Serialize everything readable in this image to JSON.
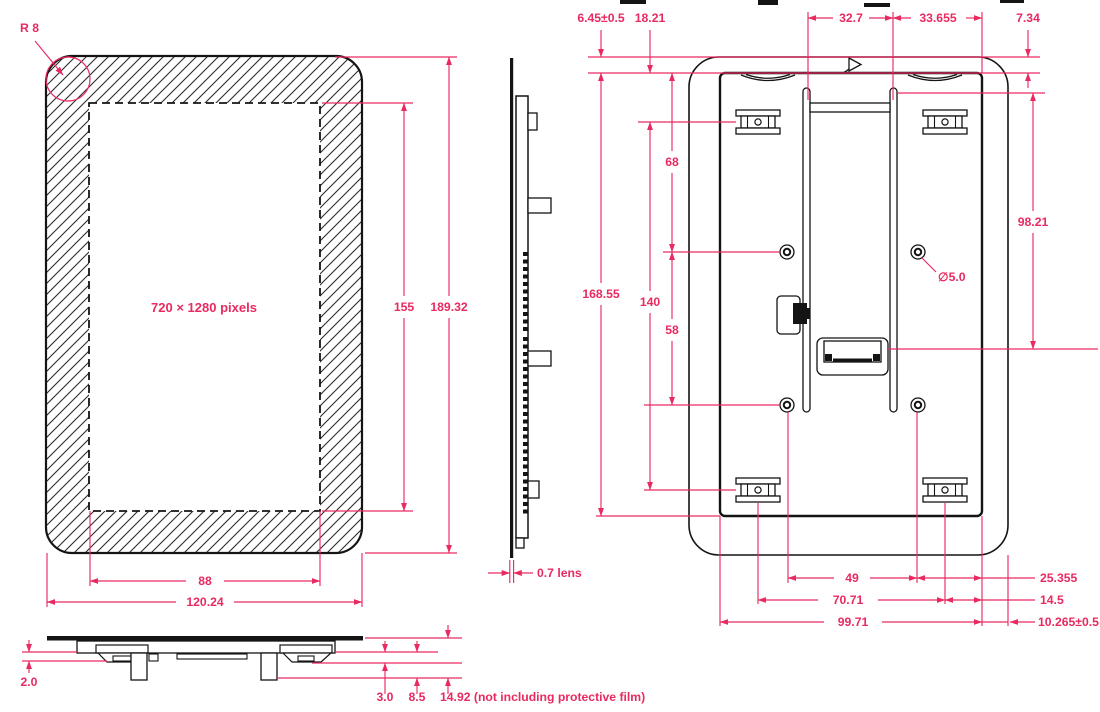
{
  "accent_color": "#e92a60",
  "ink_color": "#141414",
  "front_view": {
    "radius_label": "R 8",
    "screen_label": "720 × 1280 pixels",
    "dim_screen_height": "155",
    "dim_overall_height": "189.32",
    "dim_screen_width": "88",
    "dim_overall_width": "120.24"
  },
  "side_view": {
    "dim_lens": "0.7 lens"
  },
  "bottom_view": {
    "dim_step_small": "2.0",
    "dim_step_1": "3.0",
    "dim_step_2": "8.5",
    "dim_overall_thickness": "14.92 (not including protective film)"
  },
  "back_view": {
    "dim_top_left_offset": "6.45±0.5",
    "dim_top_inner_offset": "18.21",
    "dim_rail_span": "32.7",
    "dim_rail_to_edge": "33.655",
    "dim_top_right_offset": "7.34",
    "dim_inner_height": "168.55",
    "dim_mount_hole_span_v": "140",
    "dim_screw_top_offset": "68",
    "dim_screw_span_v": "58",
    "dim_right_height": "98.21",
    "dim_hole_diameter": "∅5.0",
    "dim_screw_span_h": "49",
    "dim_mount_hole_span_h": "70.71",
    "dim_inner_width": "99.71",
    "dim_right_offset_1": "25.355",
    "dim_right_offset_2": "14.5",
    "dim_right_offset_3": "10.265±0.5"
  }
}
